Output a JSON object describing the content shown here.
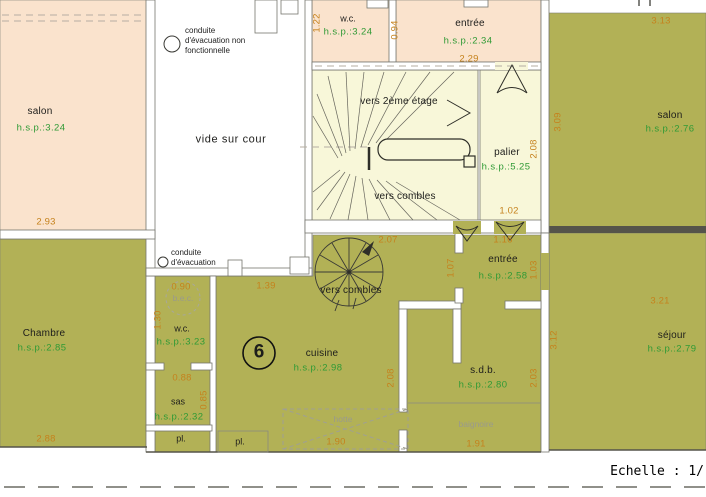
{
  "colors": {
    "room_peach": "#fae3cd",
    "room_olive": "#b2b156",
    "stair_yellow": "#f8f7d9",
    "dimension_text": "#c5821d",
    "height_text_green": "#2f9a35",
    "muted_gray": "#9a9a8c",
    "wall_gray": "#76766e"
  },
  "rooms": {
    "salon_top_left": {
      "label": "salon",
      "hsp": "h.s.p.:3.24"
    },
    "wc_top": {
      "label": "w.c.",
      "hsp": "h.s.p.:3.24"
    },
    "entree_top": {
      "label": "entrée",
      "hsp": "h.s.p.:2.34"
    },
    "palier": {
      "label": "palier",
      "hsp": "h.s.p.:5.25"
    },
    "salon_top_right": {
      "label": "salon",
      "hsp": "h.s.p.:2.76"
    },
    "chambre": {
      "label": "Chambre",
      "hsp": "h.s.p.:2.85"
    },
    "wc_bottom": {
      "label": "w.c.",
      "hsp": "h.s.p.:3.23"
    },
    "sas": {
      "label": "sas",
      "hsp": "h.s.p.:2.32"
    },
    "cuisine": {
      "label": "cuisine",
      "hsp": "h.s.p.:2.98"
    },
    "sdb": {
      "label": "s.d.b.",
      "hsp": "h.s.p.:2.80"
    },
    "sejour": {
      "label": "séjour",
      "hsp": "h.s.p.:2.79"
    },
    "entree_mid": {
      "label": "entrée",
      "hsp": "h.s.p.:2.58"
    }
  },
  "areas": {
    "vide_sur_cour": "vide sur cour",
    "closets": [
      "pl.",
      "pl."
    ],
    "unit_number": "6"
  },
  "stairs": {
    "to_second_floor": "vers 2ème étage",
    "to_attic_main": "vers combles",
    "to_attic_spiral": "vers combles"
  },
  "notes": {
    "duct_top": [
      "conduite",
      "d'évacuation non",
      "fonctionnelle"
    ],
    "duct_mid": [
      "conduite",
      "d'évacuation"
    ],
    "water_heater": "b.e.c.",
    "hood": "hotte",
    "bathtub": "baignoire"
  },
  "dims": {
    "d293": "2.93",
    "d122": "1.22",
    "d094": "0.94",
    "d229": "2.29",
    "d313": "3.13",
    "d309": "3.09",
    "d208_palier": "2.08",
    "d102": "1.02",
    "d116": "1.16",
    "d207": "2.07",
    "d107": "1.07",
    "d103": "1.03",
    "d139": "1.39",
    "d090": "0.90",
    "d130": "1.30",
    "d088": "0.88",
    "d085": "0.85",
    "d288": "2.88",
    "d208_cuisine": "2.08",
    "d203": "2.03",
    "d321": "3.21",
    "d312": "3.12",
    "d190": "1.90",
    "d191": "1.91"
  },
  "footer": {
    "scale": "Echelle : 1/"
  }
}
